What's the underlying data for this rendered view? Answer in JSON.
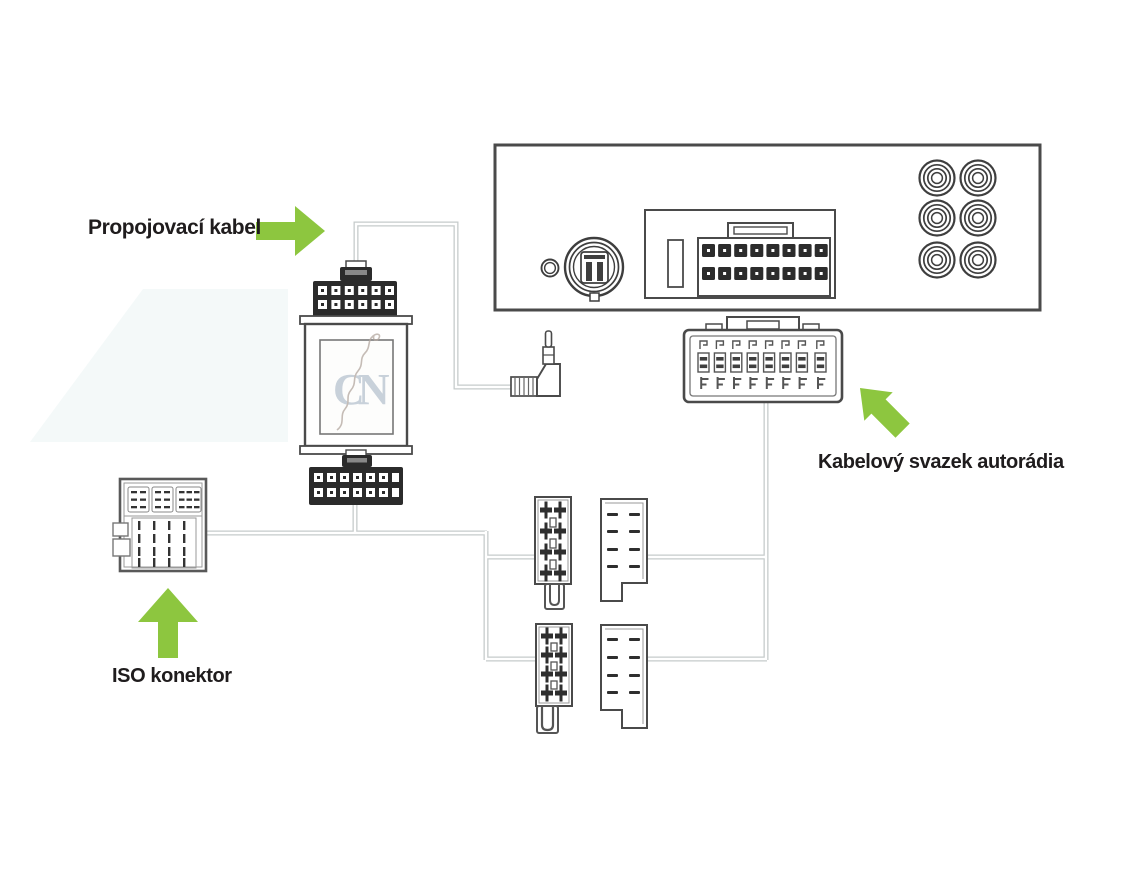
{
  "colors": {
    "accent_green": "#8dc63f",
    "outline": "#4a4a4a",
    "wire": "#c6cbcb",
    "text": "#1f1c1d"
  },
  "labels": {
    "connecting_cable": "Propojovací kabel",
    "radio_harness": "Kabelový svazek autorádia",
    "iso_connector": "ISO konektor"
  },
  "watermark": {
    "letters": "CN"
  },
  "components": {
    "radio_rear_panel": {
      "rca_jacks": 6,
      "main_socket_pins": 16
    },
    "harness_plug_pins": 16,
    "adapter_box": {
      "top_connector_pins": 12,
      "bottom_connector_pins": 14
    },
    "iso_connector_pins": 16
  }
}
